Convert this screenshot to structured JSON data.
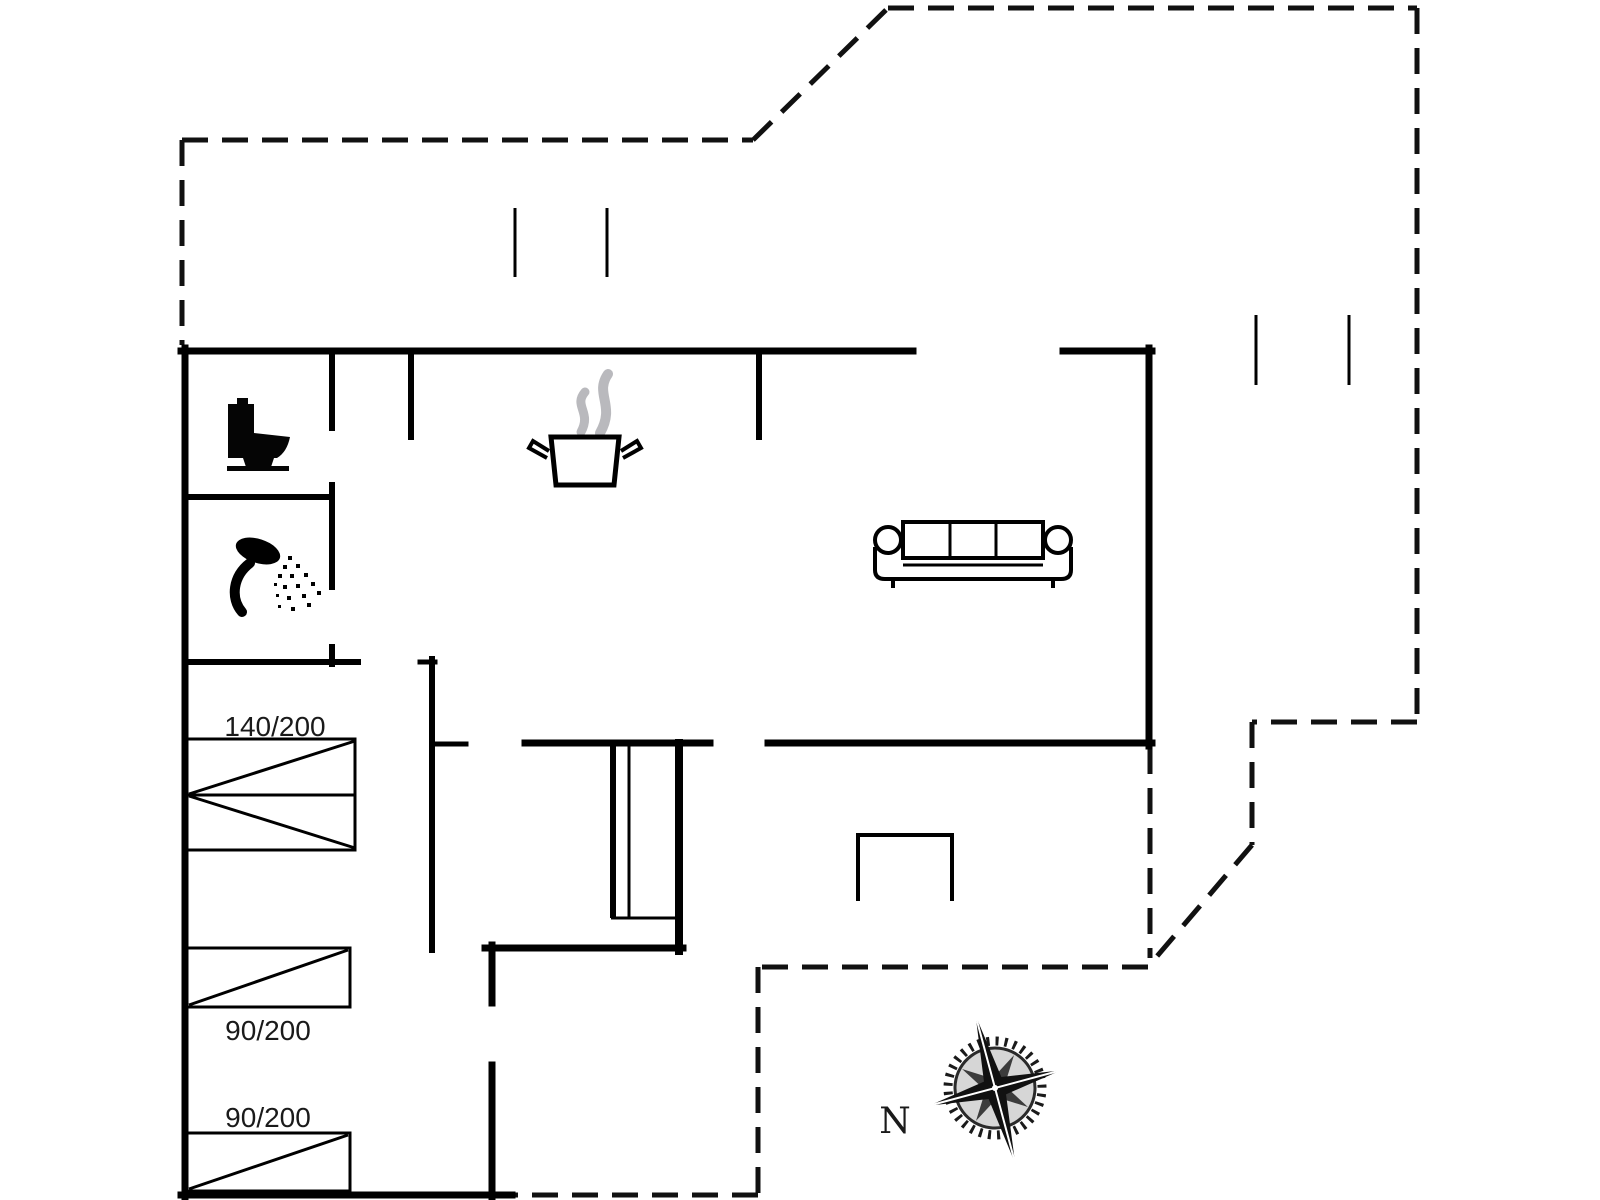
{
  "page": {
    "type": "floor-plan-drawing",
    "background": "#ffffff"
  },
  "floorplan": {
    "labels": {
      "bed_double": "140/200",
      "bed_single_1": "90/200",
      "bed_single_2": "90/200",
      "compass_north": "N"
    },
    "icons": [
      {
        "name": "toilet-icon"
      },
      {
        "name": "shower-icon"
      },
      {
        "name": "cooking-pot-icon"
      },
      {
        "name": "steam-icon"
      },
      {
        "name": "sofa-icon"
      },
      {
        "name": "fireplace-icon"
      },
      {
        "name": "stairs-icon"
      },
      {
        "name": "compass-rose-icon"
      }
    ],
    "colors": {
      "walls": "#000000",
      "terrace_outline": "#111111",
      "steam": "#b9b9bd",
      "compass_dark": "#1a1a1a",
      "compass_mid": "#3c3c3c",
      "compass_ring_fill": "#d6d6d6",
      "text": "#1a1a1a",
      "background": "#ffffff"
    }
  }
}
